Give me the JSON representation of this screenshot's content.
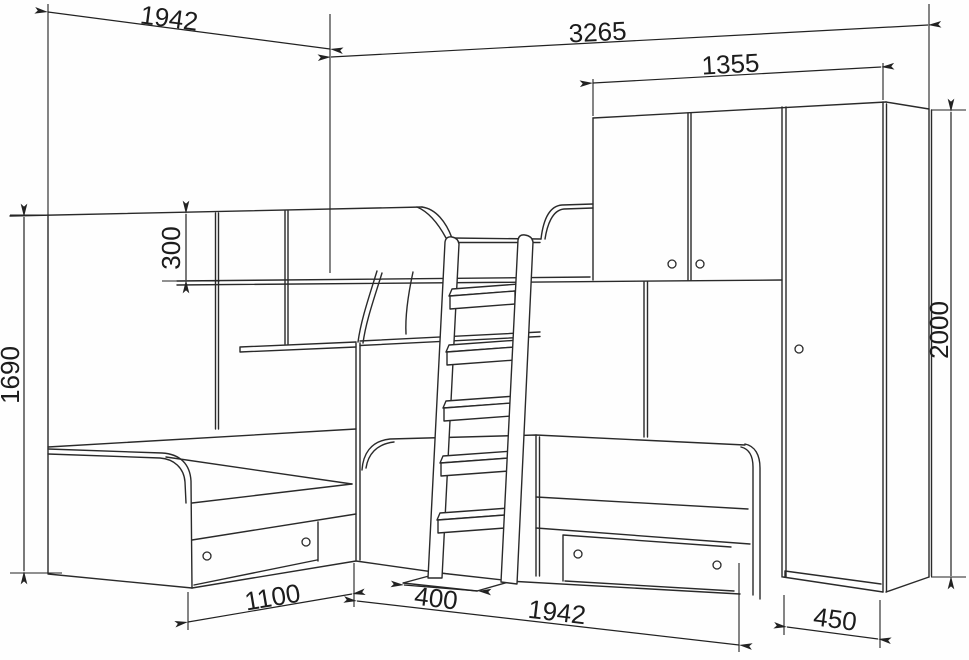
{
  "style": {
    "background": "#ffffff",
    "line_color": "#2a2a2a"
  },
  "diagram": {
    "title": "bunk-bed furniture dimension drawing",
    "dimensions": {
      "top_width_left": "1942",
      "total_width": "3265",
      "wardrobe_width": "1355",
      "rail_height": "300",
      "left_height": "1690",
      "right_height": "2000",
      "left_bed_length": "1100",
      "ladder_depth": "400",
      "bottom_width": "1942",
      "wardrobe_depth": "450"
    }
  }
}
